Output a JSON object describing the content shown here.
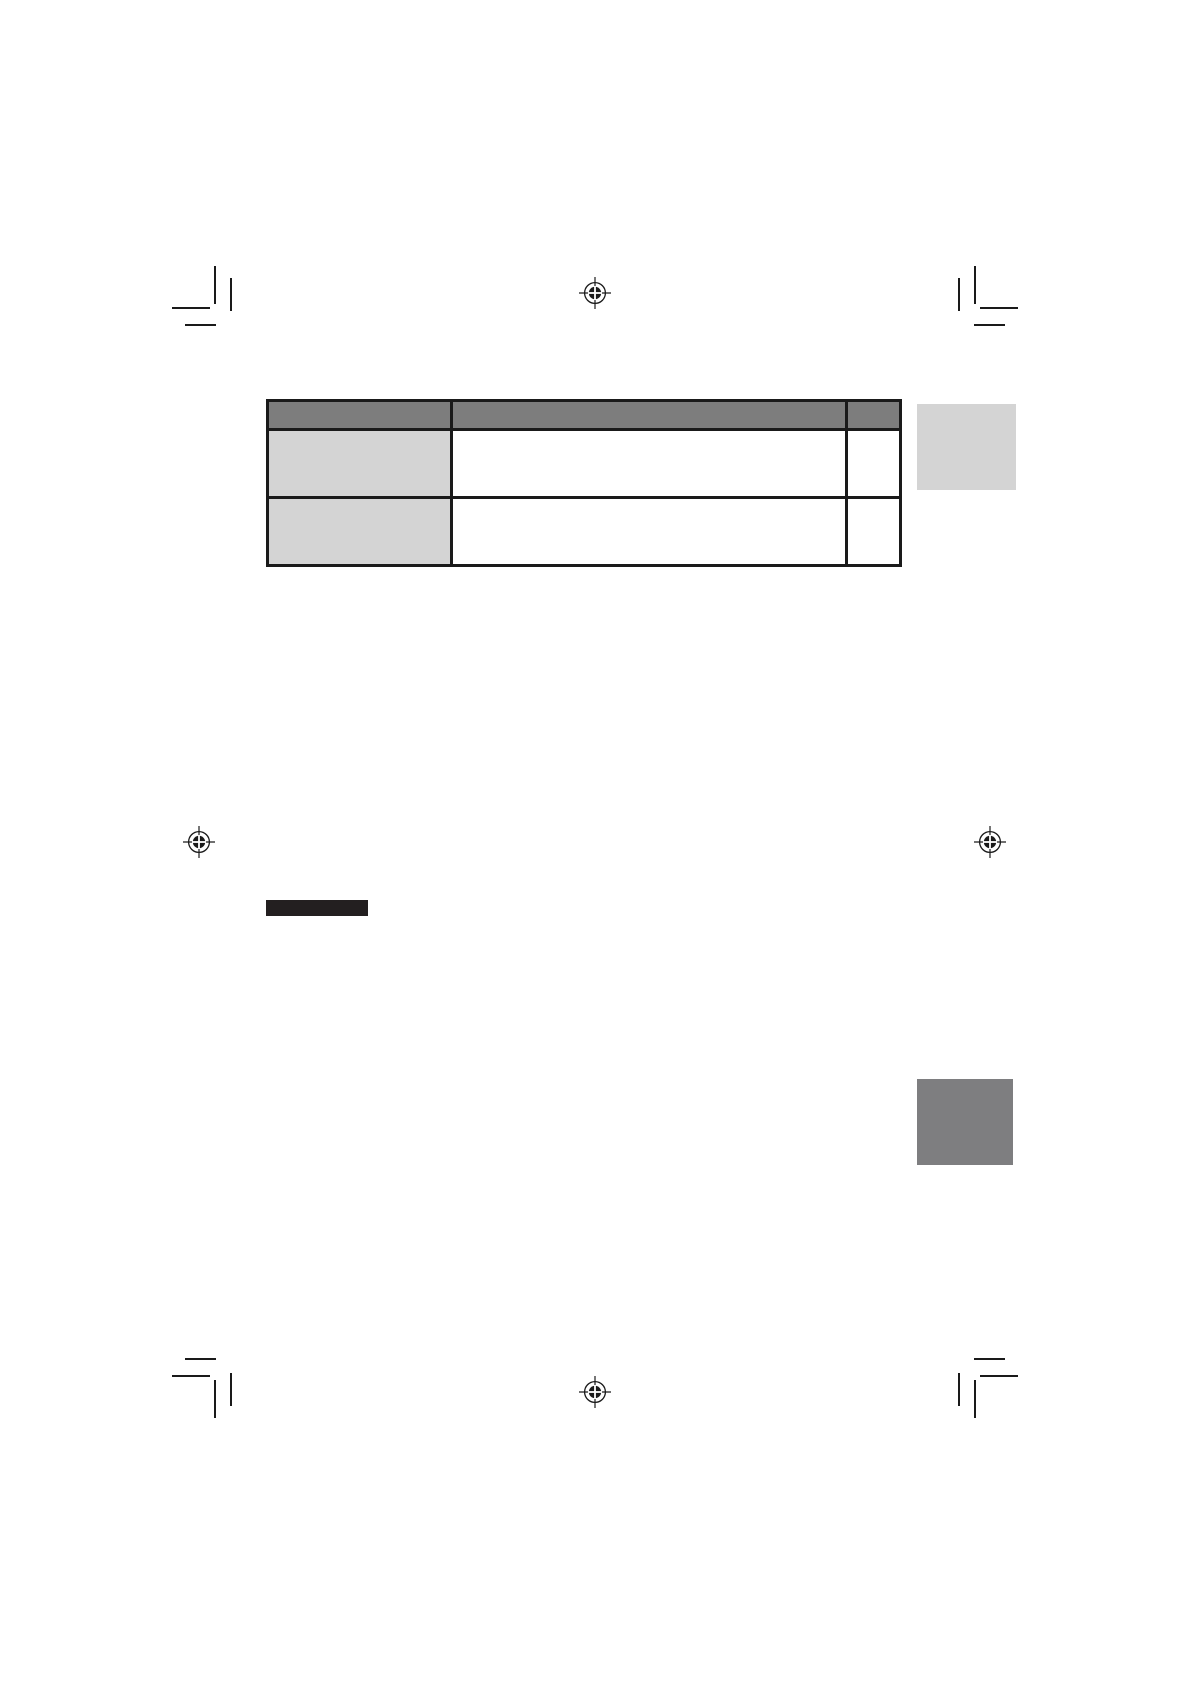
{
  "document": {
    "kind": "printed manual page proof",
    "visible_text": ""
  },
  "colors": {
    "page_background": "#ffffff",
    "table_header_fill": "#7d7d7d",
    "table_label_column_fill": "#d4d4d4",
    "table_border": "#1a1a1a",
    "page_tab_marker_fill": "#d4d4d4",
    "section_tab_marker_fill": "#7e7e80",
    "heading_bar_fill": "#231f20",
    "printer_mark_color": "#1a1a1a"
  },
  "table": {
    "columns": [
      {
        "header": ""
      },
      {
        "header": ""
      },
      {
        "header": ""
      }
    ],
    "rows": [
      {
        "cells": [
          "",
          "",
          ""
        ]
      },
      {
        "cells": [
          "",
          "",
          ""
        ]
      }
    ]
  },
  "icons": {
    "registration_marks": [
      "top-center",
      "left-middle",
      "right-middle",
      "bottom-center"
    ],
    "crop_marks": [
      "top-left",
      "top-right",
      "bottom-left",
      "bottom-right"
    ]
  }
}
